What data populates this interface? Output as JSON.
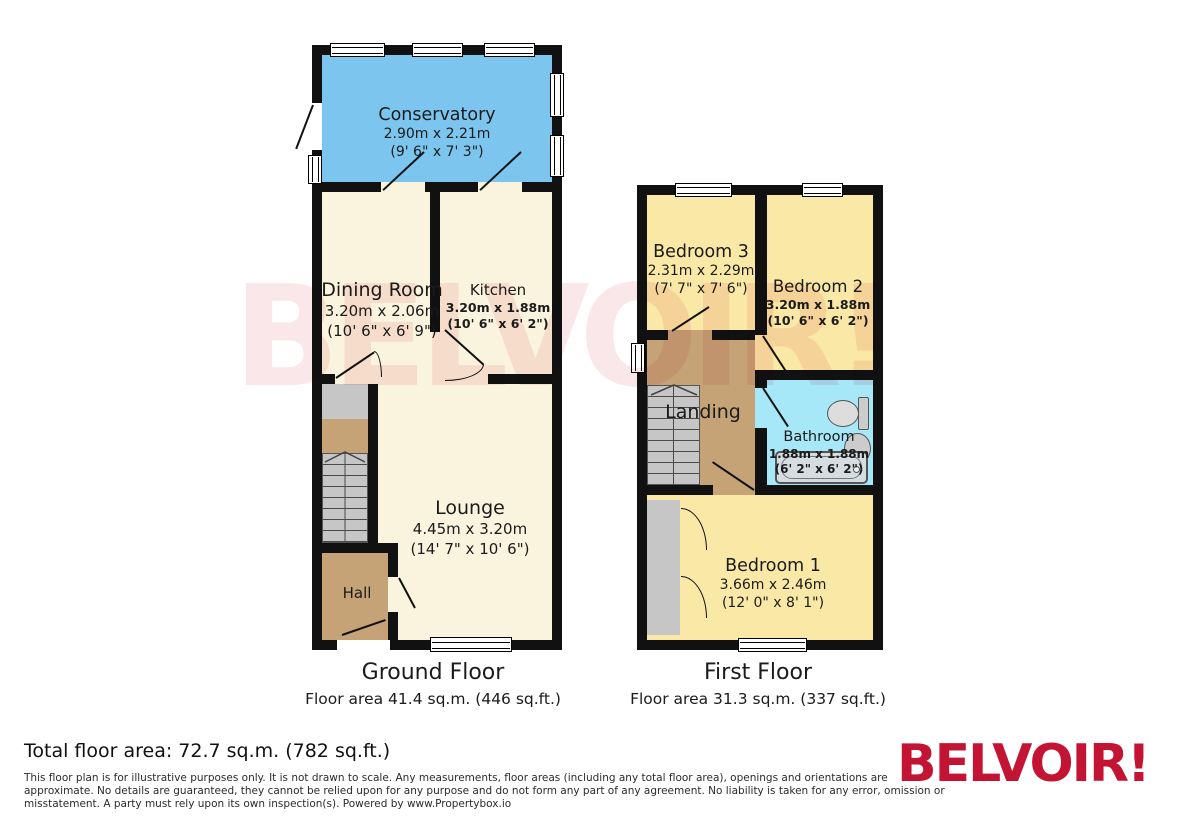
{
  "watermark_text": "BELVOIR!",
  "ground_floor": {
    "caption": "Ground Floor",
    "area_caption": "Floor area 41.4 sq.m. (446 sq.ft.)",
    "rooms": {
      "conservatory": {
        "name": "Conservatory",
        "dim_m": "2.90m x 2.21m",
        "dim_ft": "(9' 6\" x 7' 3\")"
      },
      "dining_room": {
        "name": "Dining Room",
        "dim_m": "3.20m x 2.06m",
        "dim_ft": "(10' 6\" x 6' 9\")"
      },
      "kitchen": {
        "name": "Kitchen",
        "dim_m": "3.20m x 1.88m",
        "dim_ft": "(10' 6\" x 6' 2\")"
      },
      "lounge": {
        "name": "Lounge",
        "dim_m": "4.45m x 3.20m",
        "dim_ft": "(14' 7\" x 10' 6\")"
      },
      "hall": {
        "name": "Hall"
      }
    }
  },
  "first_floor": {
    "caption": "First Floor",
    "area_caption": "Floor area 31.3 sq.m. (337 sq.ft.)",
    "rooms": {
      "bedroom3": {
        "name": "Bedroom 3",
        "dim_m": "2.31m x 2.29m",
        "dim_ft": "(7' 7\" x 7' 6\")"
      },
      "bedroom2": {
        "name": "Bedroom 2",
        "dim_m": "3.20m x 1.88m",
        "dim_ft": "(10' 6\" x 6' 2\")"
      },
      "landing": {
        "name": "Landing"
      },
      "bathroom": {
        "name": "Bathroom",
        "dim_m": "1.88m x 1.88m",
        "dim_ft": "(6' 2\" x 6' 2\")"
      },
      "bedroom1": {
        "name": "Bedroom 1",
        "dim_m": "3.66m x 2.46m",
        "dim_ft": "(12' 0\" x 8' 1\")"
      }
    }
  },
  "footer": {
    "total_area": "Total floor area: 72.7 sq.m. (782 sq.ft.)",
    "disclaimer_lines": [
      "This floor plan is for illustrative purposes only. It is not drawn to scale. Any measurements, floor areas (including any total floor area), openings and orientations are",
      "approximate. No details are guaranteed, they cannot be relied upon for any purpose and do not form any part of any agreement. No liability is taken for any error, omission or",
      "misstatement. A party must rely upon its own inspection(s). Powered by www.Propertybox.io"
    ],
    "brand": "BELVOIR!"
  },
  "colors": {
    "wall": "#111111",
    "conservatory": "#7CC5EF",
    "cream": "#FAF3DE",
    "bedroom": "#FAE9A6",
    "hall": "#C5A377",
    "bathroom": "#A6E7F8",
    "stairs": "#C6C6C6",
    "brand_red": "#C41434",
    "watermark_pink": "#C8102E"
  },
  "icons": {
    "window": "triple-line-bar",
    "door": "leaf-and-quarter-arc",
    "stairs": "tread-lines-with-up-chevron",
    "toilet": "tank-and-bowl-shape",
    "sink": "oval-basin",
    "bathtub": "rounded-rect-tub"
  }
}
